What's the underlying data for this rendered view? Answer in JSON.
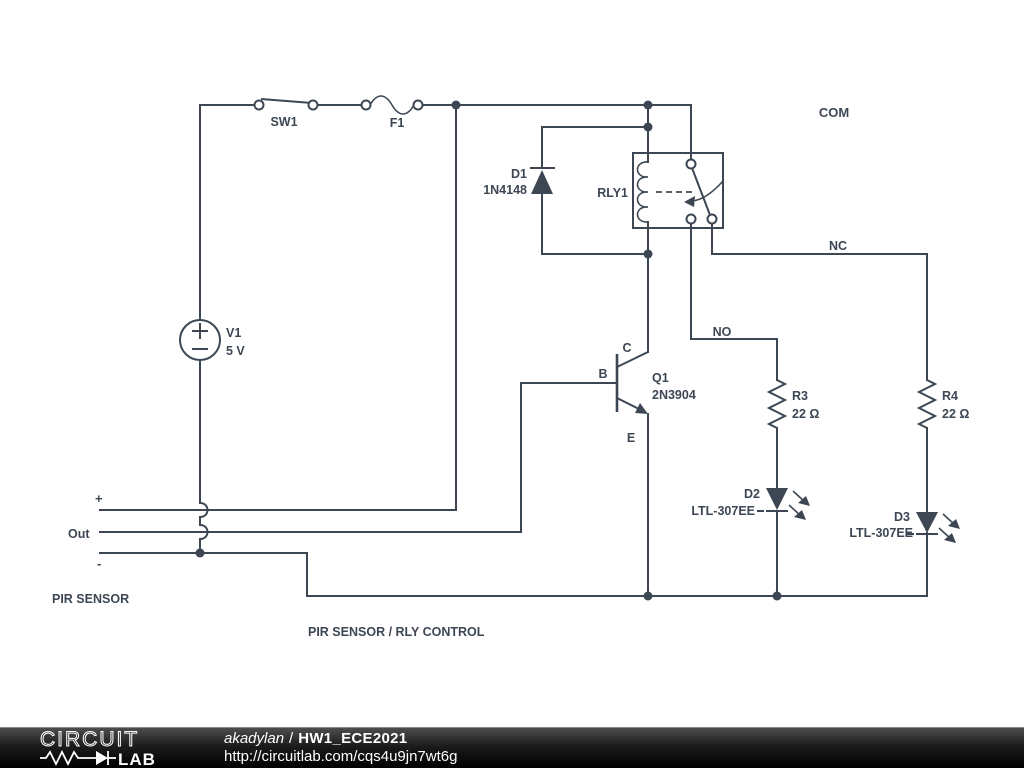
{
  "schematic": {
    "colors": {
      "wire": "#3d4754",
      "background": "#ffffff"
    },
    "labels": {
      "com": "COM",
      "nc": "NC",
      "no": "NO",
      "plus": "+",
      "out": "Out",
      "minus": "-",
      "pir_sensor": "PIR SENSOR",
      "drawing_title": "PIR SENSOR / RLY CONTROL"
    },
    "components": {
      "sw1": {
        "name": "SW1"
      },
      "f1": {
        "name": "F1"
      },
      "v1": {
        "name": "V1",
        "value": "5 V"
      },
      "d1": {
        "name": "D1",
        "value": "1N4148"
      },
      "rly1": {
        "name": "RLY1"
      },
      "q1": {
        "name": "Q1",
        "value": "2N3904",
        "pin_c": "C",
        "pin_b": "B",
        "pin_e": "E"
      },
      "r3": {
        "name": "R3",
        "value": "22 Ω"
      },
      "r4": {
        "name": "R4",
        "value": "22 Ω"
      },
      "d2": {
        "name": "D2",
        "value": "LTL-307EE"
      },
      "d3": {
        "name": "D3",
        "value": "LTL-307EE"
      }
    }
  },
  "footer": {
    "logo_line1": "CIRCUIT",
    "logo_line2": "LAB",
    "author": "akadylan",
    "separator": "/",
    "project_title": "HW1_ECE2021",
    "url": "http://circuitlab.com/cqs4u9jn7wt6g",
    "colors": {
      "bar": "#000000",
      "text": "#ffffff"
    }
  }
}
